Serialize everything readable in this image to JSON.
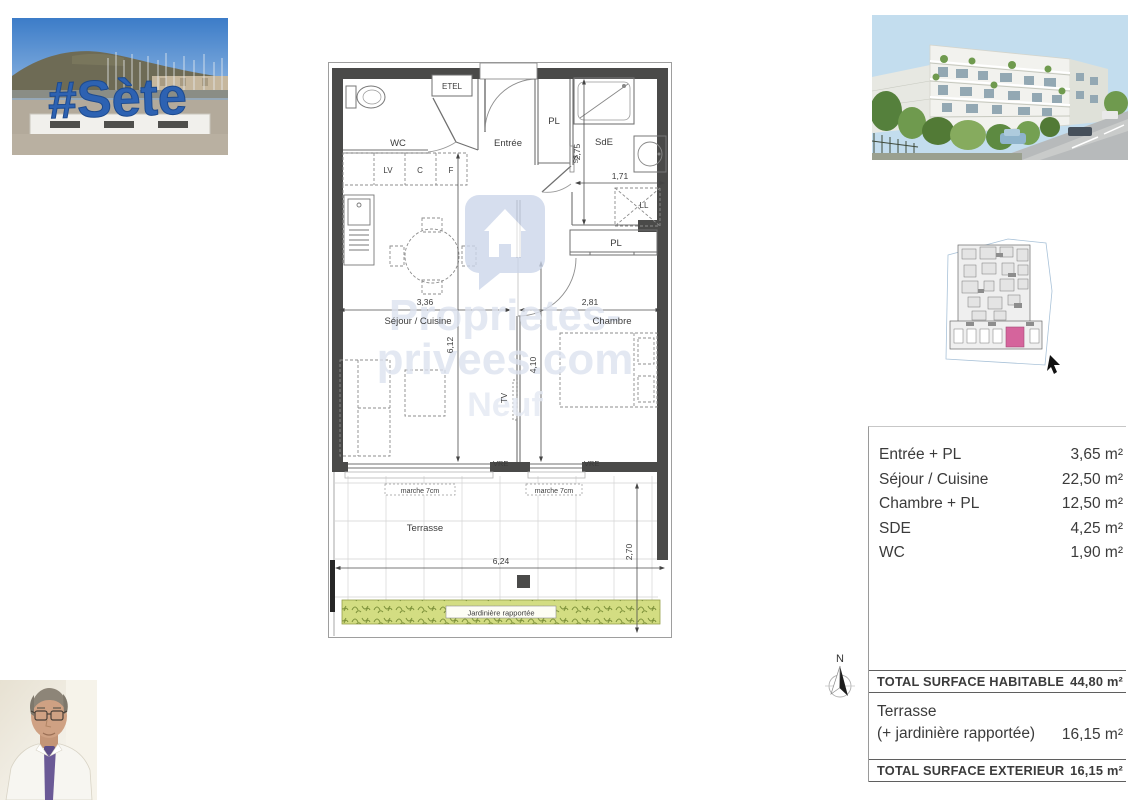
{
  "photos": {
    "harbor": {
      "sign": "#Sète"
    },
    "building": {
      "name": "residence-render"
    },
    "agent": {
      "name": "agent-portrait"
    }
  },
  "plan": {
    "rooms": {
      "wc": "WC",
      "etel": "ETEL",
      "entree": "Entrée",
      "pl_hall": "PL",
      "sde": "SdE",
      "ss": "SS",
      "ll": "LL",
      "pl_chambre": "PL",
      "lv": "LV",
      "c": "C",
      "f": "F",
      "tv": "TV",
      "sejour": "Séjour / Cuisine",
      "chambre": "Chambre",
      "terrasse": "Terrasse"
    },
    "dims": {
      "sejour_w": "3,36",
      "chambre_w": "2,81",
      "sejour_h": "6,12",
      "chambre_h": "4,10",
      "sde_h": "2,75",
      "sde_w": "1,71",
      "terrasse_w": "6,24",
      "terrasse_h": "2,70"
    },
    "windows": {
      "vre_left": "VRE",
      "vre_right": "VRE",
      "marche_left": "marche 7cm",
      "marche_right": "marche 7cm"
    },
    "jardiniere": "Jardinière rapportée",
    "watermark": {
      "l1": "Proprietes-",
      "l2": "privees.com",
      "l3": "Neuf"
    }
  },
  "compass": {
    "north": "N"
  },
  "surface_table": {
    "rows": [
      {
        "label": "Entrée + PL",
        "value": "3,65 m²"
      },
      {
        "label": "Séjour / Cuisine",
        "value": "22,50 m²"
      },
      {
        "label": "Chambre + PL",
        "value": "12,50 m²"
      },
      {
        "label": "SDE",
        "value": "4,25 m²"
      },
      {
        "label": "WC",
        "value": "1,90 m²"
      }
    ],
    "total_habitable": {
      "label": "TOTAL SURFACE HABITABLE",
      "value": "44,80 m²"
    },
    "terrasse": {
      "line1": "Terrasse",
      "line2": "(+ jardinière rapportée)",
      "value": "16,15 m²"
    },
    "total_exterieur": {
      "label": "TOTAL SURFACE EXTERIEUR",
      "value": "16,15 m²"
    }
  },
  "colors": {
    "wall": "#4a4a49",
    "accent_pink": "#d5649c",
    "jardiniere_green": "#d3dd82",
    "watermark": "#dde3ef",
    "sign_blue": "#2d62b2"
  }
}
